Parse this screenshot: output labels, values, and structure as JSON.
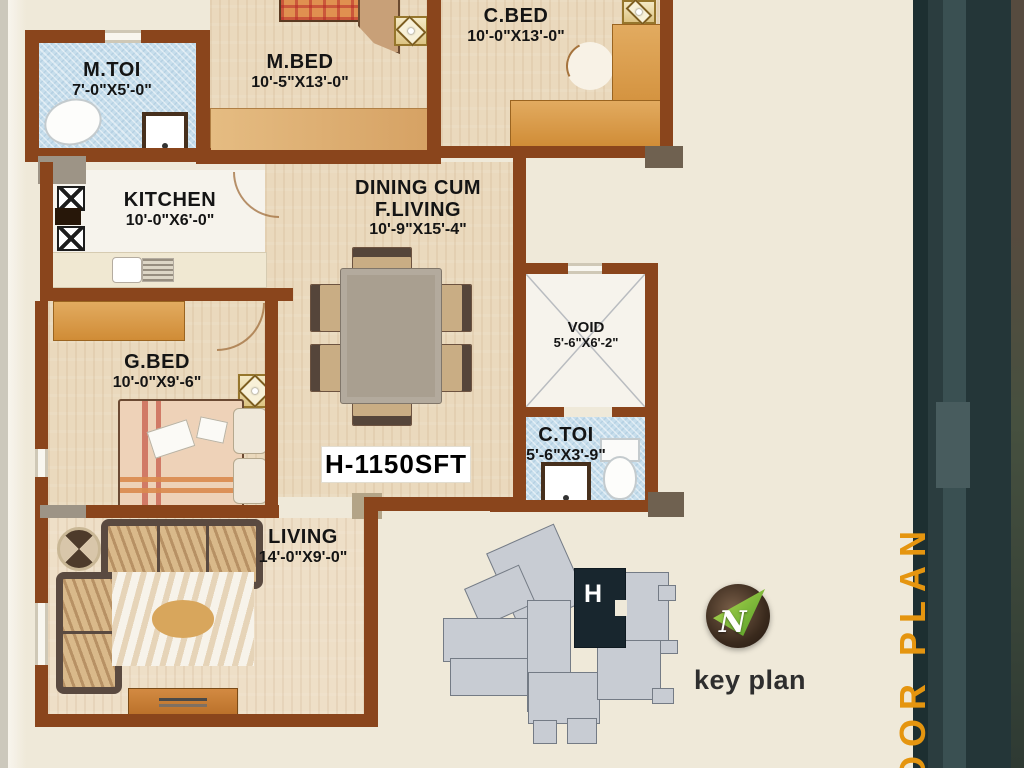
{
  "plan": {
    "area_label": "H-1150SFT",
    "rooms": [
      {
        "id": "mtoi",
        "name": "M.TOI",
        "dims": "7'-0\"X5'-0\""
      },
      {
        "id": "mbed",
        "name": "M.BED",
        "dims": "10'-5\"X13'-0\""
      },
      {
        "id": "cbed",
        "name": "C.BED",
        "dims": "10'-0\"X13'-0\""
      },
      {
        "id": "kitchen",
        "name": "KITCHEN",
        "dims": "10'-0\"X6'-0\""
      },
      {
        "id": "dining",
        "name": "DINING  CUM",
        "name2": "F.LIVING",
        "dims": "10'-9\"X15'-4\""
      },
      {
        "id": "gbed",
        "name": "G.BED",
        "dims": "10'-0\"X9'-6\""
      },
      {
        "id": "void",
        "name": "VOID",
        "dims": "5'-6\"X6'-2\""
      },
      {
        "id": "ctoi",
        "name": "C.TOI",
        "dims": "5'-6\"X3'-9\""
      },
      {
        "id": "living",
        "name": "LIVING",
        "dims": "14'-0\"X9'-0\""
      }
    ]
  },
  "key_plan": {
    "label": "key plan",
    "unit_letter": "H",
    "compass_letter": "N"
  },
  "side_banner": {
    "text": "OOR PLAN"
  },
  "colors": {
    "wall": "#8a451c",
    "banner_orange": "#e5950f",
    "tile_blue": "#c7deec",
    "wood": "#ead9bd",
    "band_dark": "#243638",
    "keyplan_gray": "#c8ccd3",
    "keyplan_dark": "#18262e"
  }
}
